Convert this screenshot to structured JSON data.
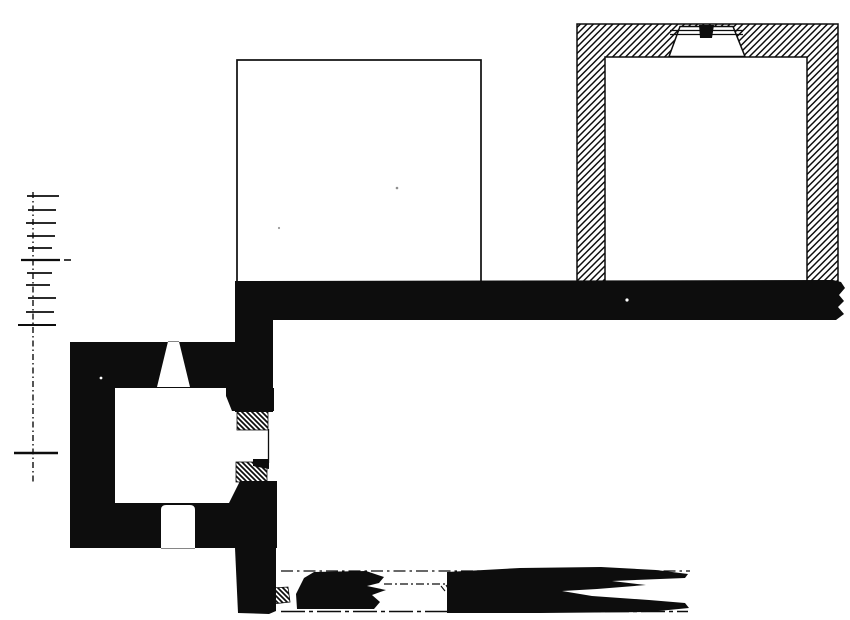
{
  "meta": {
    "kind": "scanned architectural floor plan (ink on paper, no text)",
    "canvas": {
      "width": 850,
      "height": 620
    },
    "colors": {
      "ink": "#0d0d0d",
      "paper": "#ffffff",
      "speck_gray": "#8f8f8f"
    }
  },
  "plan": {
    "legend": {
      "solid_black": "existing masonry walls",
      "diagonal_hatch": "restored / later-phase masonry",
      "thin_outline": "pavement or platform edge",
      "dash_dot": "survey axis lines",
      "scale_bar": "vertical graphic scale, 10 small divisions + far mark, no numerals visible"
    },
    "shapes": [
      {
        "name": "scale-bar-line",
        "type": "line",
        "x1": 33,
        "y1": 192,
        "x2": 33,
        "y2": 482,
        "stroke": "ink",
        "sw": 1.4,
        "dash": "6 3 1.5 3"
      },
      {
        "name": "scale-bar-tick-1",
        "type": "line",
        "x1": 27,
        "y1": 196,
        "x2": 59,
        "y2": 196,
        "stroke": "ink",
        "sw": 1.8
      },
      {
        "name": "scale-bar-tick-2",
        "type": "line",
        "x1": 28,
        "y1": 210,
        "x2": 56,
        "y2": 210,
        "stroke": "ink",
        "sw": 1.8
      },
      {
        "name": "scale-bar-tick-3",
        "type": "line",
        "x1": 26,
        "y1": 223,
        "x2": 56,
        "y2": 223,
        "stroke": "ink",
        "sw": 1.8
      },
      {
        "name": "scale-bar-tick-4",
        "type": "line",
        "x1": 27,
        "y1": 236,
        "x2": 55,
        "y2": 236,
        "stroke": "ink",
        "sw": 1.8
      },
      {
        "name": "scale-bar-tick-5",
        "type": "line",
        "x1": 28,
        "y1": 248,
        "x2": 52,
        "y2": 248,
        "stroke": "ink",
        "sw": 1.8
      },
      {
        "name": "scale-bar-tick-6-major",
        "type": "line",
        "x1": 21,
        "y1": 260,
        "x2": 60,
        "y2": 260,
        "stroke": "ink",
        "sw": 2.2
      },
      {
        "name": "scale-bar-zero-dash",
        "type": "line",
        "x1": 64,
        "y1": 260,
        "x2": 71,
        "y2": 260,
        "stroke": "ink",
        "sw": 1.6
      },
      {
        "name": "scale-bar-tick-7",
        "type": "line",
        "x1": 27,
        "y1": 273,
        "x2": 52,
        "y2": 273,
        "stroke": "ink",
        "sw": 1.8
      },
      {
        "name": "scale-bar-tick-8",
        "type": "line",
        "x1": 26,
        "y1": 285,
        "x2": 50,
        "y2": 285,
        "stroke": "ink",
        "sw": 1.8
      },
      {
        "name": "scale-bar-tick-9",
        "type": "line",
        "x1": 28,
        "y1": 298,
        "x2": 56,
        "y2": 298,
        "stroke": "ink",
        "sw": 1.8
      },
      {
        "name": "scale-bar-tick-10",
        "type": "line",
        "x1": 26,
        "y1": 312,
        "x2": 54,
        "y2": 312,
        "stroke": "ink",
        "sw": 1.8
      },
      {
        "name": "scale-bar-tick-11-major",
        "type": "line",
        "x1": 18,
        "y1": 325,
        "x2": 56,
        "y2": 325,
        "stroke": "ink",
        "sw": 2.0
      },
      {
        "name": "scale-bar-far-mark",
        "type": "line",
        "x1": 14,
        "y1": 453,
        "x2": 58,
        "y2": 453,
        "stroke": "ink",
        "sw": 2.4
      },
      {
        "name": "hall-platform-outline",
        "type": "rect",
        "x": 237,
        "y": 60,
        "w": 244,
        "h": 222,
        "fill": "none",
        "stroke": "ink",
        "sw": 1.7
      },
      {
        "name": "chamber-hatched-walls",
        "type": "path",
        "d": "M577 24 L838 24 L838 283 L807 283 L807 57 L605 57 L605 283 L577 283 Z M680 26.5 L733 26.5 L745 56.5 L669 56.5 Z",
        "fill": "hatch-fwd",
        "stroke": "ink",
        "sw": 1.5,
        "rule": "evenodd"
      },
      {
        "name": "chamber-door-threshold-line-1",
        "type": "line",
        "x1": 670,
        "y1": 30.5,
        "x2": 743,
        "y2": 30.5,
        "stroke": "ink",
        "sw": 1.2
      },
      {
        "name": "chamber-door-threshold-line-2",
        "type": "line",
        "x1": 670,
        "y1": 34.5,
        "x2": 743,
        "y2": 34.5,
        "stroke": "ink",
        "sw": 1.2
      },
      {
        "name": "chamber-door-pillar",
        "type": "polygon",
        "points": [
          [
            699,
            25
          ],
          [
            714,
            25
          ],
          [
            712,
            38
          ],
          [
            700,
            38
          ]
        ],
        "fill": "ink"
      },
      {
        "name": "main-wall",
        "type": "polygon",
        "points": [
          [
            235,
            281
          ],
          [
            833,
            280
          ],
          [
            841,
            282
          ],
          [
            845,
            288
          ],
          [
            839,
            295
          ],
          [
            844,
            301
          ],
          [
            838,
            307
          ],
          [
            844,
            314
          ],
          [
            836,
            320
          ],
          [
            235,
            320
          ]
        ],
        "fill": "ink"
      },
      {
        "name": "annex-connector-wall",
        "type": "rect",
        "x": 235,
        "y": 318,
        "w": 38,
        "h": 94,
        "fill": "ink"
      },
      {
        "name": "annex-north-wall",
        "type": "path",
        "d": "M70 342 L237 342 L237 388 L70 388 Z M168 341.5 L179 341.5 L190 387 L157 387 Z",
        "fill": "ink",
        "rule": "evenodd"
      },
      {
        "name": "annex-west-wall",
        "type": "rect",
        "x": 70,
        "y": 342,
        "w": 45,
        "h": 206,
        "fill": "ink"
      },
      {
        "name": "annex-south-wall",
        "type": "path",
        "d": "M70 503 L237 503 L237 548 L70 548 Z M161 548.5 L161 510 Q161 505 166 505 L190 505 Q195 505 195 510 L195 548.5 Z",
        "fill": "ink",
        "rule": "evenodd"
      },
      {
        "name": "annex-corner-ne",
        "type": "polygon",
        "points": [
          [
            226,
            388
          ],
          [
            274,
            388
          ],
          [
            274,
            411
          ],
          [
            232,
            411
          ],
          [
            226,
            396
          ]
        ],
        "fill": "ink"
      },
      {
        "name": "survey-axis-upper",
        "type": "line",
        "x1": 281,
        "y1": 571,
        "x2": 690,
        "y2": 571,
        "stroke": "ink",
        "sw": 1.3,
        "dash": "12 4 2.5 4"
      },
      {
        "name": "survey-axis-short",
        "type": "line",
        "x1": 384,
        "y1": 584,
        "x2": 449,
        "y2": 584,
        "stroke": "ink",
        "sw": 1.2,
        "dash": "8 3 2 3"
      },
      {
        "name": "survey-baseline",
        "type": "line",
        "x1": 281,
        "y1": 611.5,
        "x2": 688,
        "y2": 611.5,
        "stroke": "ink",
        "sw": 1.4,
        "dash": "24 4 4 4"
      },
      {
        "name": "door-jamb-hatch-upper",
        "type": "rect",
        "x": 237,
        "y": 411,
        "w": 31,
        "h": 19,
        "fill": "hatch-back",
        "stroke": "ink",
        "sw": 0.8
      },
      {
        "name": "door-outer-face-line",
        "type": "line",
        "x1": 268.5,
        "y1": 429,
        "x2": 268.5,
        "y2": 463,
        "stroke": "ink",
        "sw": 1.3
      },
      {
        "name": "door-jamb-hatch-lower",
        "type": "rect",
        "x": 236,
        "y": 462,
        "w": 31,
        "h": 20,
        "fill": "hatch-back",
        "stroke": "ink",
        "sw": 0.8
      },
      {
        "name": "door-jamb-cap",
        "type": "polygon",
        "points": [
          [
            253,
            459
          ],
          [
            269,
            459
          ],
          [
            269,
            469
          ],
          [
            253,
            466
          ]
        ],
        "fill": "ink"
      },
      {
        "name": "annex-corner-se",
        "type": "polygon",
        "points": [
          [
            228,
            548
          ],
          [
            228,
            505
          ],
          [
            240,
            481
          ],
          [
            277,
            481
          ],
          [
            277,
            548
          ]
        ],
        "fill": "ink"
      },
      {
        "name": "south-wall-lower",
        "type": "polygon",
        "points": [
          [
            235,
            548
          ],
          [
            276,
            548
          ],
          [
            276,
            611
          ],
          [
            269,
            614
          ],
          [
            238,
            613
          ]
        ],
        "fill": "ink"
      },
      {
        "name": "ruin-hatch-patch",
        "type": "polygon",
        "points": [
          [
            271,
            588
          ],
          [
            288,
            587
          ],
          [
            290,
            602
          ],
          [
            272,
            604
          ]
        ],
        "fill": "hatch-back",
        "stroke": "ink",
        "sw": 0.8
      },
      {
        "name": "ruin-wall-west",
        "type": "polygon",
        "points": [
          [
            297,
            609
          ],
          [
            296,
            594
          ],
          [
            304,
            578
          ],
          [
            314,
            572
          ],
          [
            366,
            571
          ],
          [
            384,
            577
          ],
          [
            379,
            583
          ],
          [
            367,
            586
          ],
          [
            386,
            590
          ],
          [
            372,
            595
          ],
          [
            380,
            602
          ],
          [
            374,
            609
          ]
        ],
        "fill": "ink"
      },
      {
        "name": "ruin-wall-east",
        "type": "polygon",
        "points": [
          [
            447,
            572
          ],
          [
            520,
            568
          ],
          [
            601,
            567
          ],
          [
            656,
            570
          ],
          [
            688,
            574
          ],
          [
            685,
            578
          ],
          [
            612,
            581
          ],
          [
            646,
            585
          ],
          [
            597,
            589
          ],
          [
            562,
            591
          ],
          [
            592,
            596
          ],
          [
            649,
            600
          ],
          [
            685,
            603
          ],
          [
            689,
            608
          ],
          [
            648,
            612
          ],
          [
            540,
            613
          ],
          [
            447,
            613
          ]
        ],
        "fill": "ink"
      },
      {
        "name": "survey-tick-mark-1",
        "type": "line",
        "x1": 441,
        "y1": 586,
        "x2": 445,
        "y2": 591,
        "stroke": "ink",
        "sw": 1.1
      },
      {
        "name": "survey-tick-mark-2",
        "type": "line",
        "x1": 446,
        "y1": 585,
        "x2": 449,
        "y2": 590,
        "stroke": "ink",
        "sw": 1.1
      },
      {
        "name": "paper-speck-1",
        "type": "circle",
        "cx": 397,
        "cy": 188,
        "r": 1.3,
        "fill": "#8f8f8f"
      },
      {
        "name": "paper-speck-2",
        "type": "circle",
        "cx": 279,
        "cy": 228,
        "r": 1.1,
        "fill": "#9a9a9a"
      },
      {
        "name": "wall-void-speck-1",
        "type": "circle",
        "cx": 627,
        "cy": 300,
        "r": 1.6,
        "fill": "paper"
      },
      {
        "name": "wall-void-speck-2",
        "type": "circle",
        "cx": 101,
        "cy": 378,
        "r": 1.4,
        "fill": "paper"
      }
    ]
  }
}
